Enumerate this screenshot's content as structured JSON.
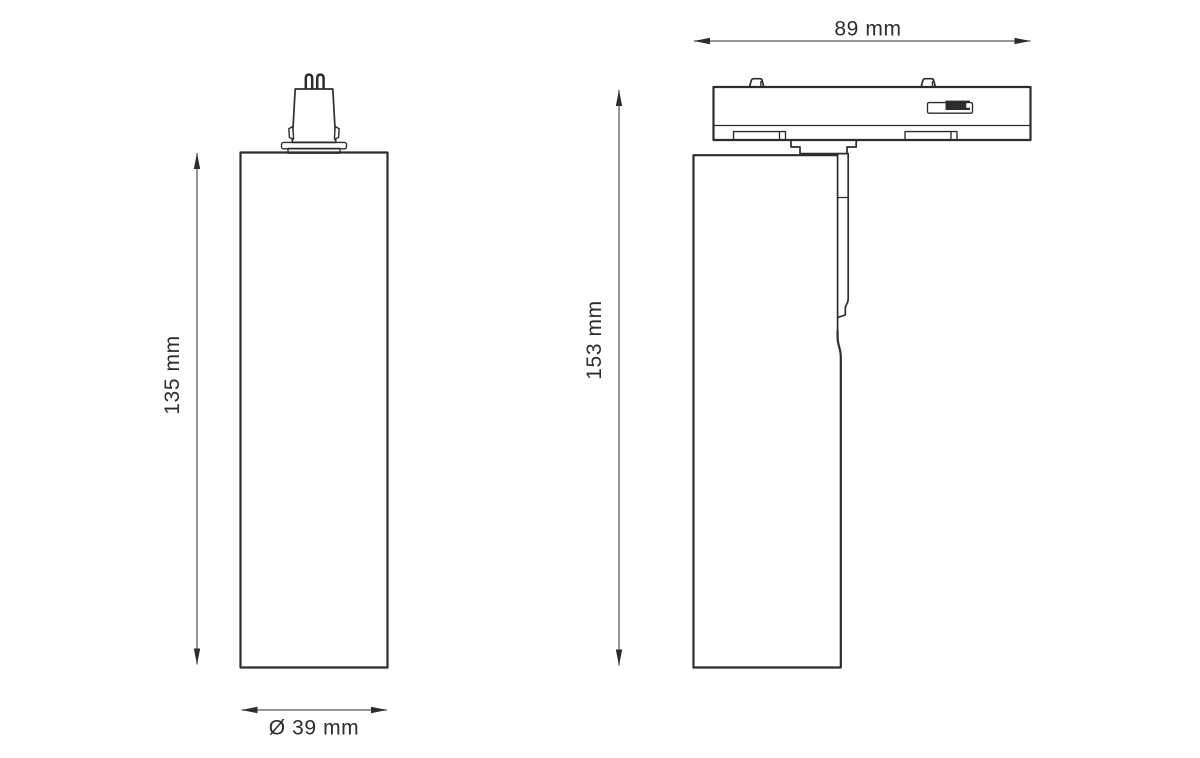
{
  "drawing": {
    "colors": {
      "bg": "#ffffff",
      "ink": "#2d2d2d",
      "dim": "#565656"
    },
    "views": {
      "front": {
        "height_label": "135 mm",
        "diameter_label": "Ø 39 mm"
      },
      "side": {
        "width_label": "89 mm",
        "height_label": "153 mm"
      }
    }
  }
}
